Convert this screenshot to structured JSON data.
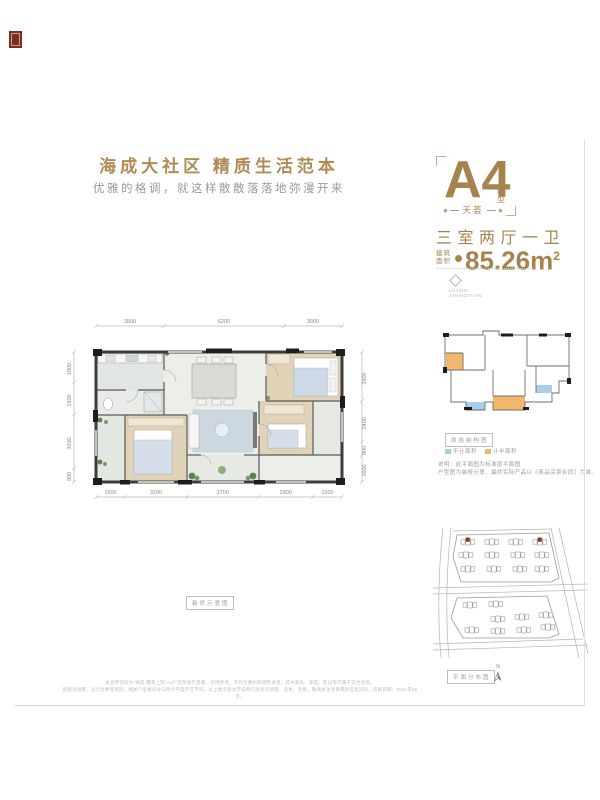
{
  "page": {
    "accent_color": "#a6834e",
    "seal_color": "#7d2e1f",
    "title": "海成大社区 精质生活范本",
    "subtitle": "优雅的格调，就这样散散落落地弥漫开来"
  },
  "unit_panel": {
    "unit_name": "A4",
    "unit_suffix_chars": [
      "户",
      "型"
    ],
    "series": "天荟",
    "layout": "三室两厅一卫",
    "area_label_line1": "建筑",
    "area_label_line2": "面积",
    "area_value": "85.26m",
    "area_sup": "2",
    "brand_line1": "LUJING",
    "brand_line2": "SHANGYUAN"
  },
  "floor_plan": {
    "caption": "装修示意图",
    "dims_top": [
      "3500",
      "6200",
      "3000"
    ],
    "dims_bottom": [
      "1500",
      "3200",
      "3700",
      "2800",
      "1500"
    ],
    "dims_left": [
      "1800",
      "1900",
      "3200",
      "800"
    ],
    "dims_right": [
      "2900",
      "2400",
      "800",
      "1600"
    ]
  },
  "structure_panel": {
    "caption": "原始结构图",
    "legend": [
      {
        "label": "不计面积",
        "color": "#a9cde8"
      },
      {
        "label": "计半面积",
        "color": "#f2b66d"
      }
    ],
    "note_line1": "说明：此平面图为标准层平面图",
    "note_line2": "户型图为装修示意，最终实际产品以《商品买卖合同》为准。"
  },
  "site_panel": {
    "caption": "平面分布图",
    "north_label": "N",
    "highlight_color": "#8a3425"
  },
  "footer": {
    "disclaimer_line1": "本宣传资料为“海成·麓景上院”A4户型装修示意图，仅供参考，不作为要约和销售承诺，其中家具、家电、陈设等不属于交付范围，",
    "disclaimer_line2": "因规划调整、设计变更等原因，相关户型格局会与所示平面存在不同，以上图示及文字说明可能有所调整、变更、完善，敬请关注项目最新信息资料，印刷日期：2021年08月。"
  }
}
